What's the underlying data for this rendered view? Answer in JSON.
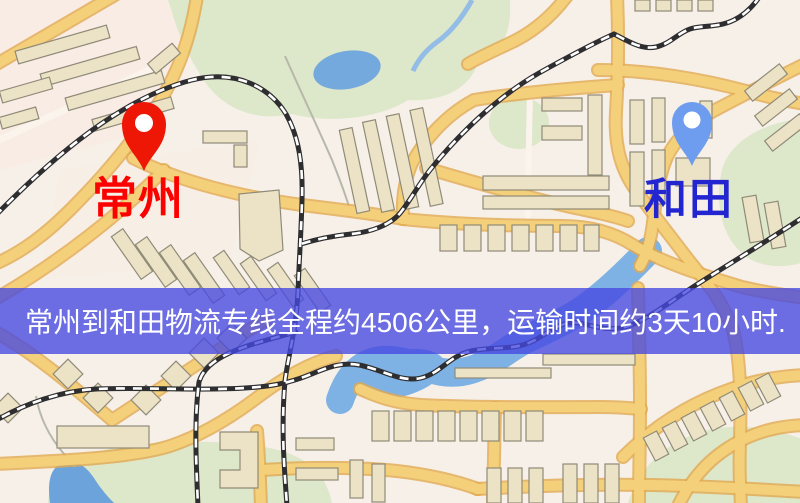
{
  "map": {
    "markers": {
      "origin": {
        "name": "常州",
        "icon": "map-pin-icon",
        "pin_color": "#ee1605",
        "label_color": "#fb0200"
      },
      "destination": {
        "name": "和田",
        "icon": "map-pin-icon",
        "pin_color": "#6e9cee",
        "label_color": "#2326d0"
      }
    },
    "info_banner": {
      "text": "常州到和田物流专线全程约4506公里，运输时间约3天10小时.",
      "background_rgba": "rgba(69,72,226,0.78)",
      "text_color": "#ffffff",
      "distance_km": 4506,
      "duration": "3天10小时"
    },
    "palette": {
      "land": "#f6f0e8",
      "park": "#dde7ca",
      "water": "#77abdf",
      "road_fill": "#f4d07a",
      "road_casing": "#e2a94f",
      "railway": "#2e2e31",
      "building": "#ece3c6"
    }
  }
}
